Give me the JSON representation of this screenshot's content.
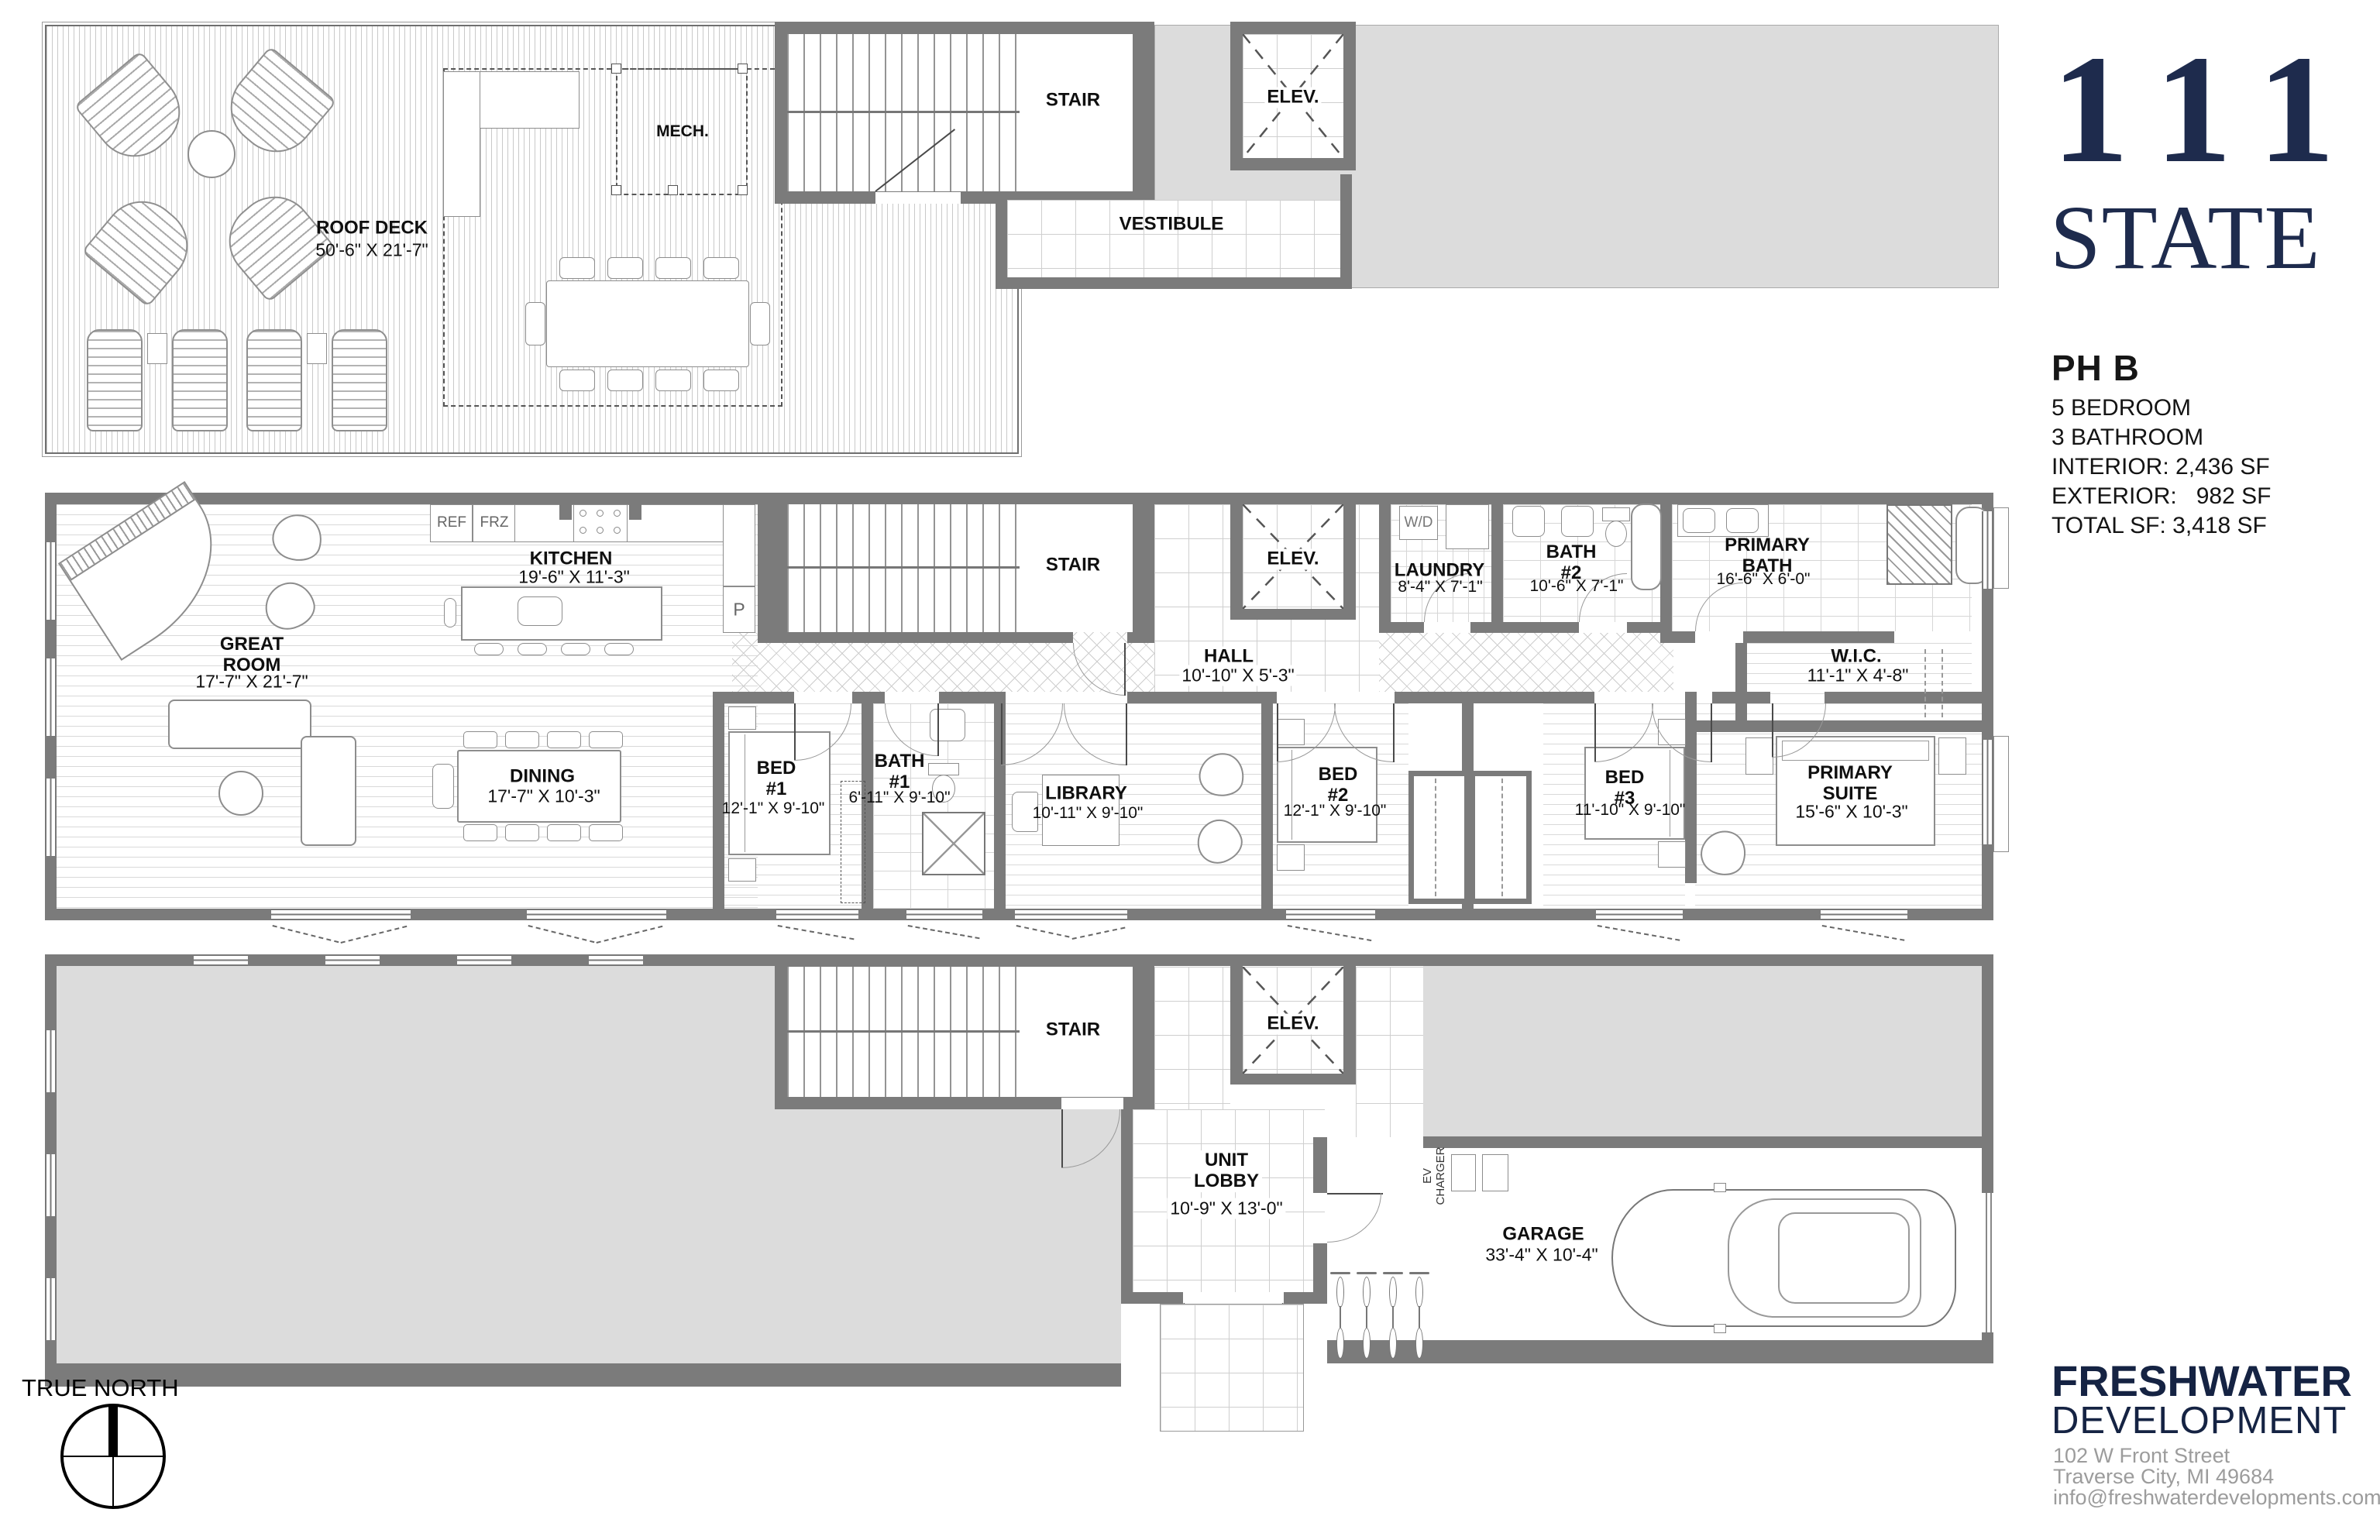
{
  "title_block": {
    "logo_line1": "111",
    "logo_line2": "STATE",
    "unit_name": "PH B",
    "spec_lines": [
      "5 BEDROOM",
      "3 BATHROOM",
      "INTERIOR: 2,436 SF",
      "EXTERIOR:   982 SF",
      "TOTAL SF: 3,418 SF"
    ]
  },
  "developer_block": {
    "name_line1": "FRESHWATER",
    "name_line2": "DEVELOPMENT",
    "address_line1": "102 W Front Street",
    "address_line2": "Traverse City, MI 49684",
    "email": "info@freshwaterdevelopments.com"
  },
  "compass": {
    "label": "TRUE NORTH"
  },
  "colors": {
    "wall": "#7b7b7b",
    "roof_fill": "#dcdcdc",
    "brand_navy": "#1e2b4d",
    "address_gray": "#9c9c9c"
  },
  "roof_plan": {
    "roof_deck_name": "ROOF DECK",
    "roof_deck_dims": "50'-6\" X 21'-7\"",
    "mech_label": "MECH.",
    "stair_label": "STAIR",
    "elev_label": "ELEV.",
    "vestibule_label": "VESTIBULE"
  },
  "main_plan": {
    "great_room_name": "GREAT\nROOM",
    "great_room_dims": "17'-7\" X 21'-7\"",
    "kitchen_name": "KITCHEN",
    "kitchen_dims": "19'-6\" X 11'-3\"",
    "ref_label": "REF",
    "frz_label": "FRZ",
    "pantry_label": "P",
    "dining_name": "DINING",
    "dining_dims": "17'-7\" X 10'-3\"",
    "stair_label": "STAIR",
    "elev_label": "ELEV.",
    "hall_name": "HALL",
    "hall_dims": "10'-10\" X 5'-3\"",
    "bed1_name": "BED\n#1",
    "bed1_dims": "12'-1\" X 9'-10\"",
    "bath1_name": "BATH\n#1",
    "bath1_dims": "6'-11\" X 9'-10\"",
    "library_name": "LIBRARY",
    "library_dims": "10'-11\" X 9'-10\"",
    "laundry_name": "LAUNDRY",
    "laundry_dims": "8'-4\" X 7'-1\"",
    "wd_label": "W/D",
    "bath2_name": "BATH\n#2",
    "bath2_dims": "10'-6\" X 7'-1\"",
    "primary_bath_name": "PRIMARY\nBAT H",
    "primary_bath_dims": "16'-6\" X 6'-0\"",
    "wic_name": "W.I.C.",
    "wic_dims": "11'-1\" X 4'-8\"",
    "bed2_name": "BED\n#2",
    "bed2_dims": "12'-1\" X 9'-10\"",
    "bed3_name": "BED\n#3",
    "bed3_dims": "11'-10\" X 9'-10\"",
    "primary_suite_name": "PRIMARY\nSUITE",
    "primary_suite_dims": "15'-6\" X 10'-3\""
  },
  "ground_plan": {
    "stair_label": "STAIR",
    "elev_label": "ELEV.",
    "unit_lobby_name": "UNIT\nLOBBY",
    "unit_lobby_dims": "10'-9\" X 13'-0\"",
    "garage_name": "GARAGE",
    "garage_dims": "33'-4\" X 10'-4\"",
    "ev_charger_label": "EV\nCHARGER"
  }
}
